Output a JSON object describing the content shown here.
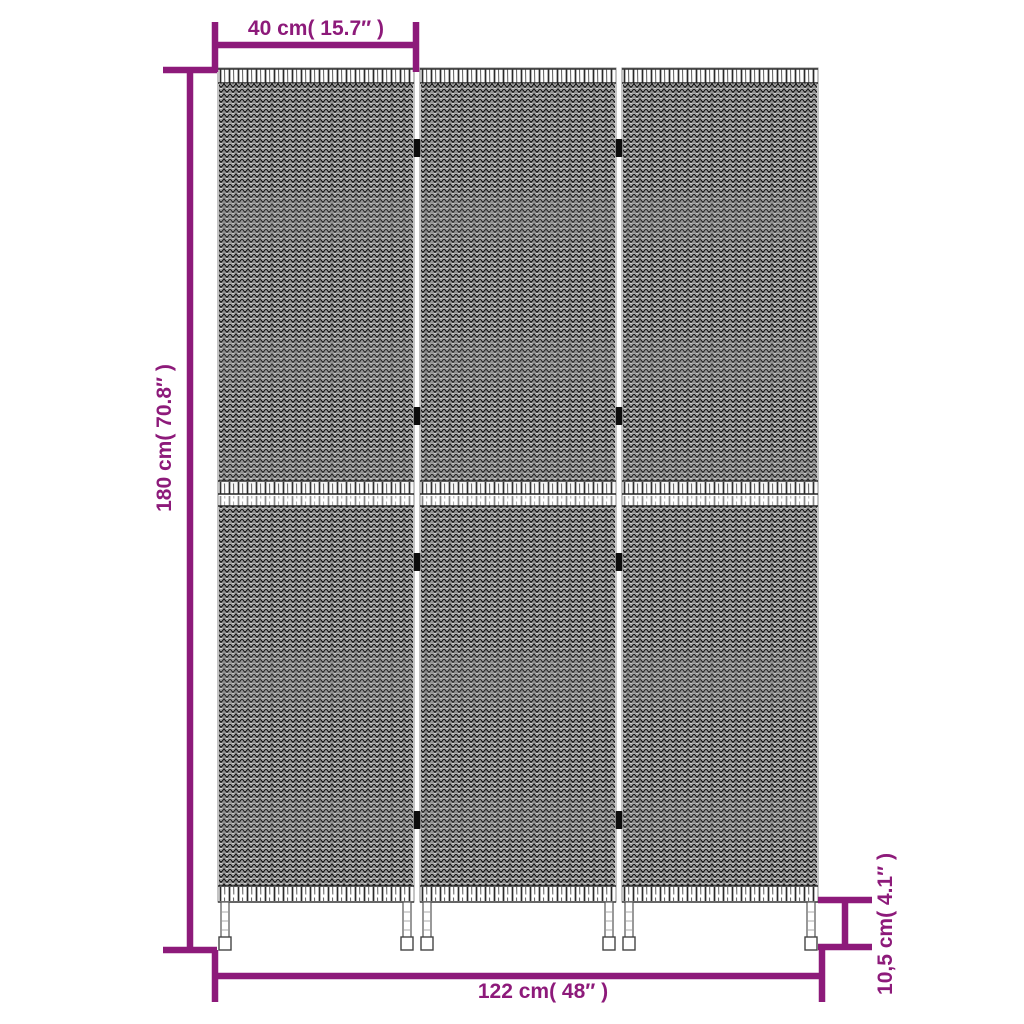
{
  "labels": {
    "panel_width": "40 cm( 15.7″ )",
    "total_height": "180 cm( 70.8″ )",
    "total_width": "122 cm( 48″ )",
    "foot_height": "10,5 cm( 4.1″ )"
  },
  "colors": {
    "dimension_accent": "#8d1a7a",
    "weave_dark": "#1a1a1a",
    "weave_light": "#6f6f6f"
  },
  "figure": {
    "description_labels_visible": 4
  }
}
